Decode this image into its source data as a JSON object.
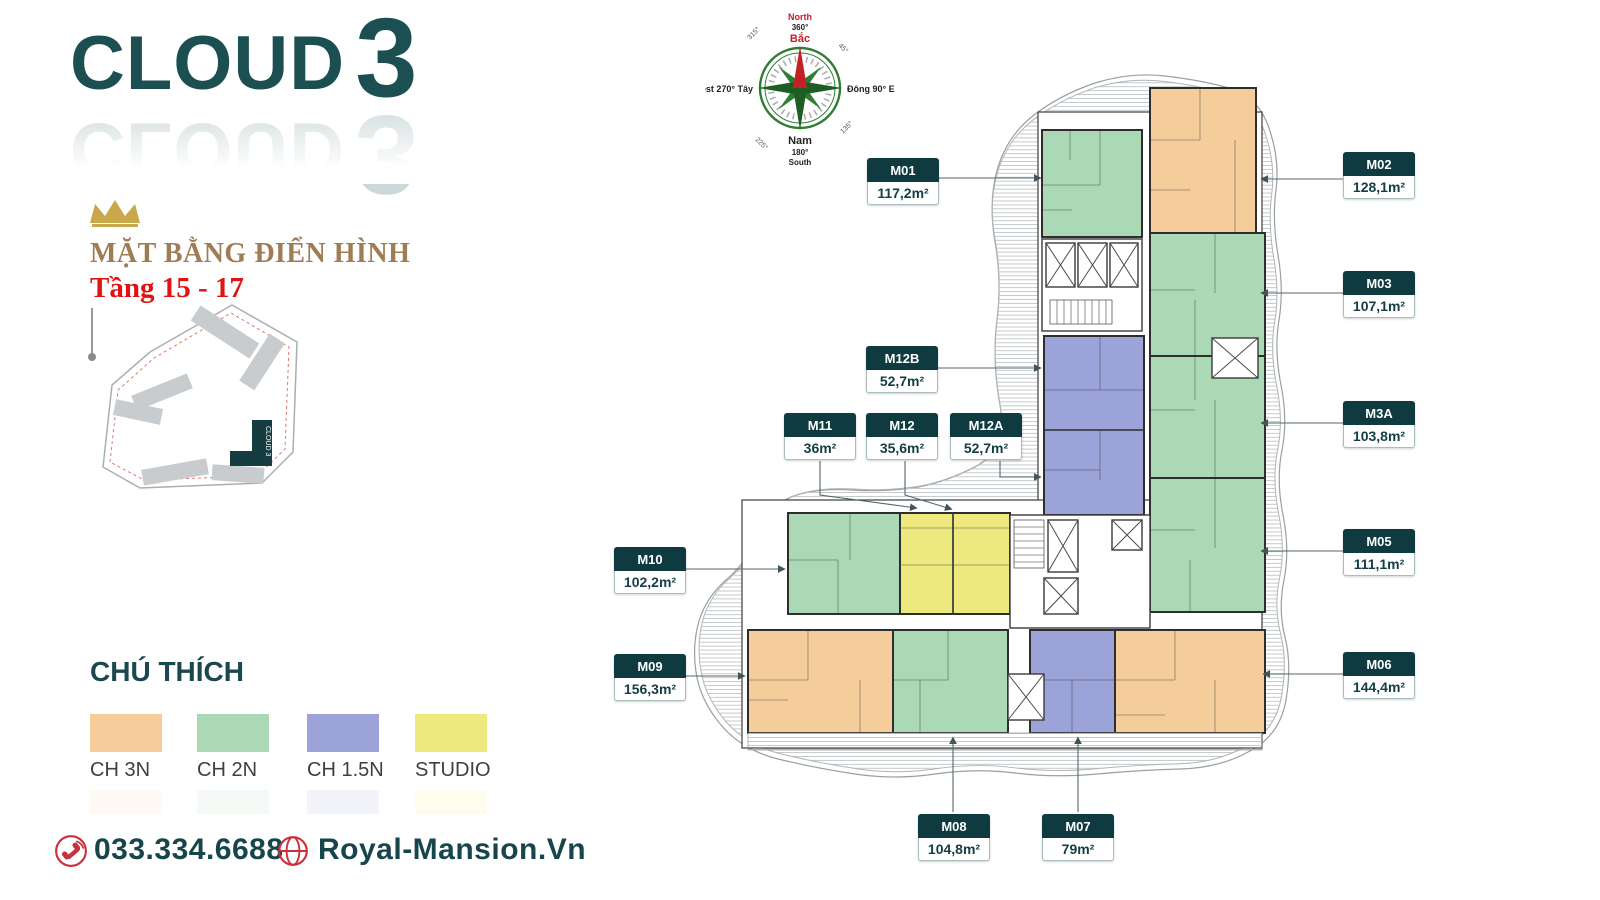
{
  "brand": {
    "name": "CLOUD",
    "number": "3"
  },
  "header": {
    "title": "MẶT BẰNG ĐIỂN HÌNH",
    "floors": "Tầng 15 - 17"
  },
  "site_map": {
    "building_label": "CLOUD 3"
  },
  "compass": {
    "north_en": "North",
    "north_deg": "360°",
    "north_vi": "Bắc",
    "west_label": "West 270° Tây",
    "east_label": "Đông 90° East",
    "south_vi": "Nam",
    "south_deg": "180°",
    "south_en": "South",
    "ne_deg": "45°",
    "se_deg": "135°",
    "sw_deg": "225°",
    "nw_deg": "315°"
  },
  "plan": {
    "units": [
      {
        "id": "M01",
        "area": "117,2m²",
        "type": "CH 2N"
      },
      {
        "id": "M02",
        "area": "128,1m²",
        "type": "CH 3N"
      },
      {
        "id": "M03",
        "area": "107,1m²",
        "type": "CH 2N"
      },
      {
        "id": "M3A",
        "area": "103,8m²",
        "type": "CH 2N"
      },
      {
        "id": "M05",
        "area": "111,1m²",
        "type": "CH 2N"
      },
      {
        "id": "M06",
        "area": "144,4m²",
        "type": "CH 3N"
      },
      {
        "id": "M07",
        "area": "79m²",
        "type": "CH 1.5N"
      },
      {
        "id": "M08",
        "area": "104,8m²",
        "type": "CH 2N"
      },
      {
        "id": "M09",
        "area": "156,3m²",
        "type": "CH 3N"
      },
      {
        "id": "M10",
        "area": "102,2m²",
        "type": "CH 2N"
      },
      {
        "id": "M11",
        "area": "36m²",
        "type": "STUDIO"
      },
      {
        "id": "M12",
        "area": "35,6m²",
        "type": "STUDIO"
      },
      {
        "id": "M12A",
        "area": "52,7m²",
        "type": "CH 1.5N"
      },
      {
        "id": "M12B",
        "area": "52,7m²",
        "type": "CH 1.5N"
      }
    ]
  },
  "legend": {
    "title": "CHÚ THÍCH",
    "items": [
      {
        "label": "CH 3N",
        "color": "#F4CD9B"
      },
      {
        "label": "CH 2N",
        "color": "#ABD9B5"
      },
      {
        "label": "CH 1.5N",
        "color": "#9BA3D8"
      },
      {
        "label": "STUDIO",
        "color": "#EDE97F"
      }
    ]
  },
  "contact": {
    "phone": "033.334.6688",
    "website": "Royal-Mansion.Vn"
  }
}
